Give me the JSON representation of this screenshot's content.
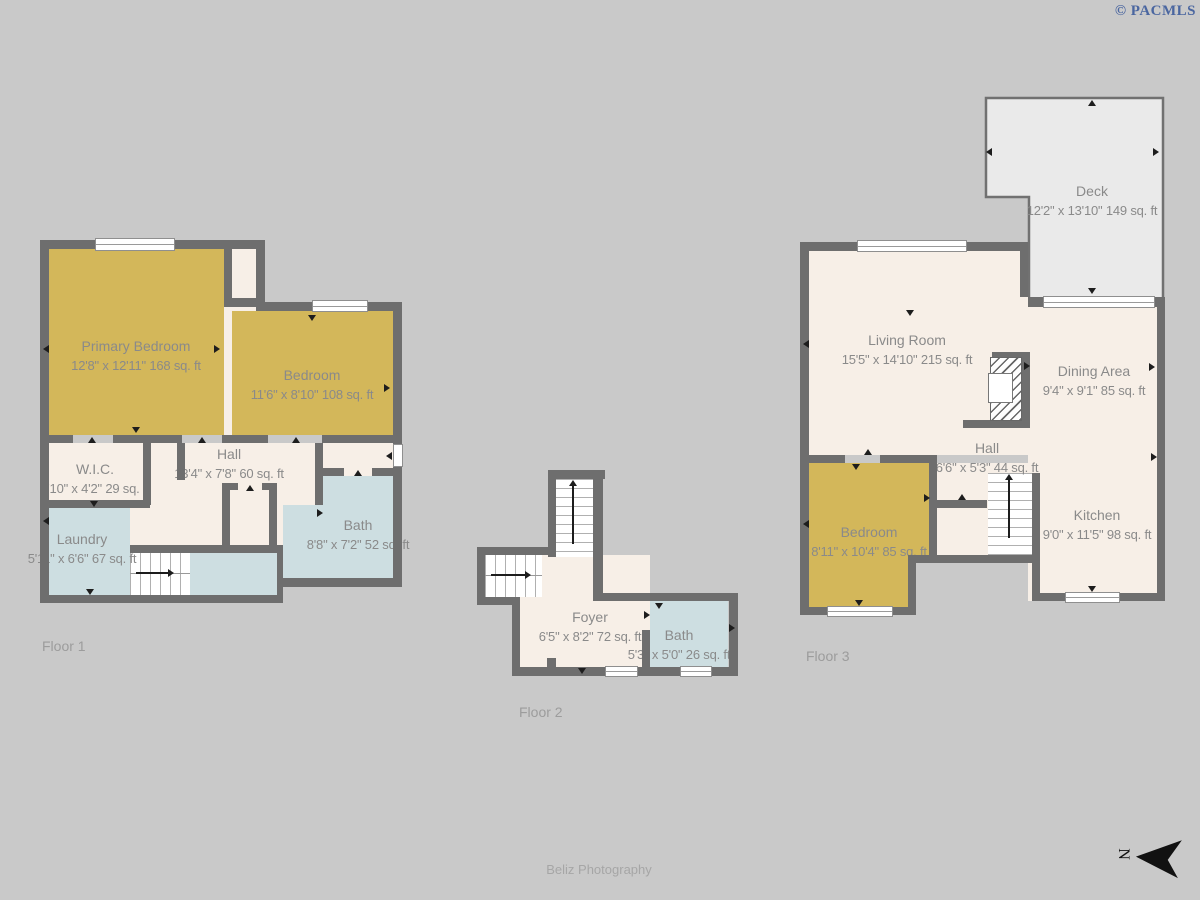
{
  "watermark": {
    "text": "© PACMLS"
  },
  "credit": {
    "text": "Beliz Photography"
  },
  "compass": {
    "letter": "N"
  },
  "colors": {
    "background": "#c9c9c9",
    "wall": "#6e6e6e",
    "room_cream": "#f7efe7",
    "room_yellow": "#d3b75a",
    "room_blue": "#cddee1",
    "deck_fill": "#eaeaea",
    "label_text": "#8a8a8a",
    "watermark_blue": "#4a66a0"
  },
  "floors": [
    {
      "label": "Floor 1",
      "rooms": [
        {
          "name": "Primary Bedroom",
          "dims": "12'8\" x 12'11\" 168 sq. ft"
        },
        {
          "name": "Bedroom",
          "dims": "11'6\" x 8'10\" 108 sq. ft"
        },
        {
          "name": "W.I.C.",
          "dims": "6'10\" x 4'2\" 29 sq. ft"
        },
        {
          "name": "Hall",
          "dims": "13'4\" x 7'8\" 60 sq. ft"
        },
        {
          "name": "Laundry",
          "dims": "5'11\" x 6'6\" 67 sq. ft"
        },
        {
          "name": "Bath",
          "dims": "8'8\" x 7'2\" 52 sq. ft"
        }
      ]
    },
    {
      "label": "Floor 2",
      "rooms": [
        {
          "name": "Foyer",
          "dims": "6'5\" x 8'2\" 72 sq. ft"
        },
        {
          "name": "Bath",
          "dims": "5'3\" x 5'0\" 26 sq. ft"
        }
      ]
    },
    {
      "label": "Floor 3",
      "rooms": [
        {
          "name": "Deck",
          "dims": "12'2\" x 13'10\" 149 sq. ft"
        },
        {
          "name": "Living Room",
          "dims": "15'5\" x 14'10\" 215 sq. ft"
        },
        {
          "name": "Dining Area",
          "dims": "9'4\" x 9'1\" 85 sq. ft"
        },
        {
          "name": "Hall",
          "dims": "6'6\" x 5'3\" 44 sq. ft"
        },
        {
          "name": "Bedroom",
          "dims": "8'11\" x 10'4\" 85 sq. ft"
        },
        {
          "name": "Kitchen",
          "dims": "9'0\" x 11'5\" 98 sq. ft"
        }
      ]
    }
  ]
}
